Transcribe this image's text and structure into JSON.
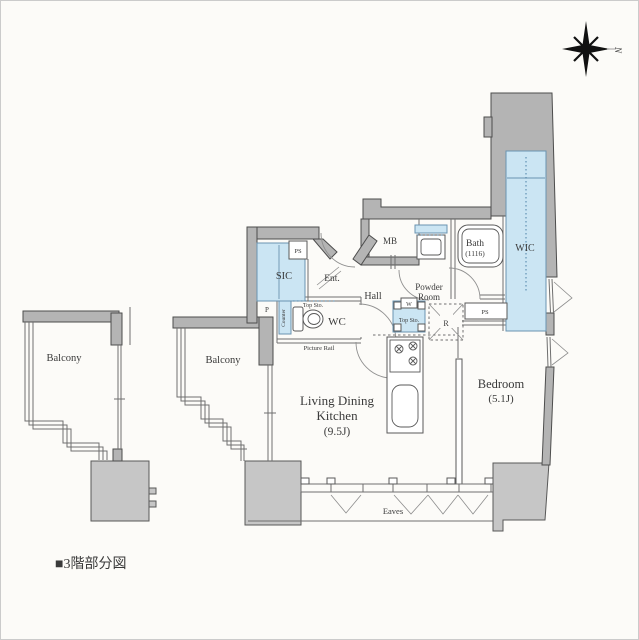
{
  "meta": {
    "type": "floor-plan",
    "footer_caption": "■3階部分図"
  },
  "compass": {
    "north_label": "N"
  },
  "rooms": {
    "balcony_left": "Balcony",
    "balcony_mid": "Balcony",
    "sic": "SIC",
    "ps_top": "PS",
    "p": "P",
    "entrance": "Ent.",
    "hall": "Hall",
    "wc": "WC",
    "wc_top_storage": "Top Sto.",
    "counter": "Counter",
    "picture_rail": "Picture Rail",
    "mb": "MB",
    "powder_line1": "Powder",
    "powder_line2": "Room",
    "bath_line1": "Bath",
    "bath_line2": "(1116)",
    "washer": "W",
    "washer_top_storage": "Top Sto.",
    "refrigerator": "R",
    "ps_bottom": "PS",
    "wic": "WIC",
    "ldk_line1": "Living Dining",
    "ldk_line2": "Kitchen",
    "ldk_line3": "(9.5J)",
    "bedroom_line1": "Bedroom",
    "bedroom_line2": "(5.1J)",
    "eaves": "Eaves"
  },
  "colors": {
    "background": "#fcfbf8",
    "frame_border": "#cbcbcb",
    "wall_fill": "#b4b4b4",
    "wall_stroke": "#4d4d4d",
    "neighbor_block_fill": "#c6c6c6",
    "closet_fill": "#cbe5f3",
    "closet_stroke": "#6a93b0",
    "thin_line": "#6f6f6f",
    "label_text": "#3a3a3a",
    "footer_text": "#1b1b1b"
  }
}
